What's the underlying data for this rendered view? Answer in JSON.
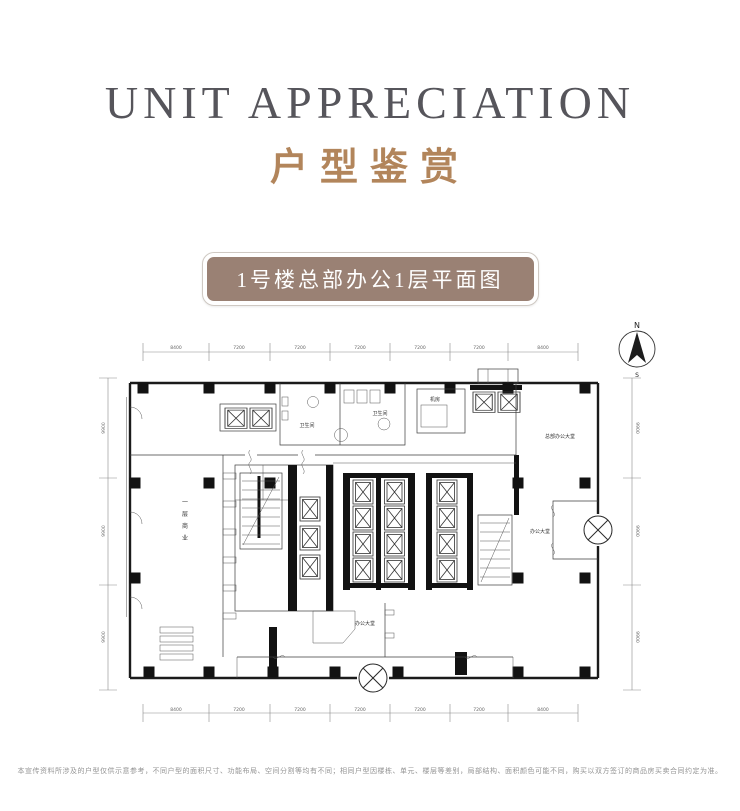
{
  "header": {
    "title_en": "UNIT APPRECIATION",
    "title_cn": "户型鉴赏",
    "title_en_color": "#56555b",
    "title_cn_color": "#b2855b"
  },
  "badge": {
    "label": "1号楼总部办公1层平面图",
    "bg_color": "#9a8174",
    "text_color": "#ffffff"
  },
  "floorplan": {
    "compass": {
      "north": "N",
      "south": "S"
    },
    "dimensions": {
      "top": [
        "8400",
        "7200",
        "7200",
        "7200",
        "7200",
        "7200",
        "8400"
      ],
      "bottom": [
        "8400",
        "7200",
        "7200",
        "7200",
        "7200",
        "7200",
        "8400"
      ],
      "left": [
        "9900",
        "9900",
        "9900"
      ],
      "right": [
        "9900",
        "9900",
        "9900"
      ]
    },
    "labels": {
      "retail_vertical": [
        "一",
        "层",
        "商",
        "业"
      ],
      "lobby_main": "总部办公大堂",
      "lobby_right": "办公大堂",
      "lobby_bottom": "办公大堂",
      "toilet_left": "卫生间",
      "toilet_right": "卫生间",
      "equipment_room": "机房"
    },
    "line_color": "#1b1b1b"
  },
  "footer": {
    "disclaimer": "本宣传资料所涉及的户型仅供示意参考，不同户型的面积尺寸、功能布局、空间分割等均有不同；相同户型因楼栋、单元、楼层等差别，局部结构、面积颜色可能不同，购买以双方签订的商品房买卖合同约定为准。"
  }
}
